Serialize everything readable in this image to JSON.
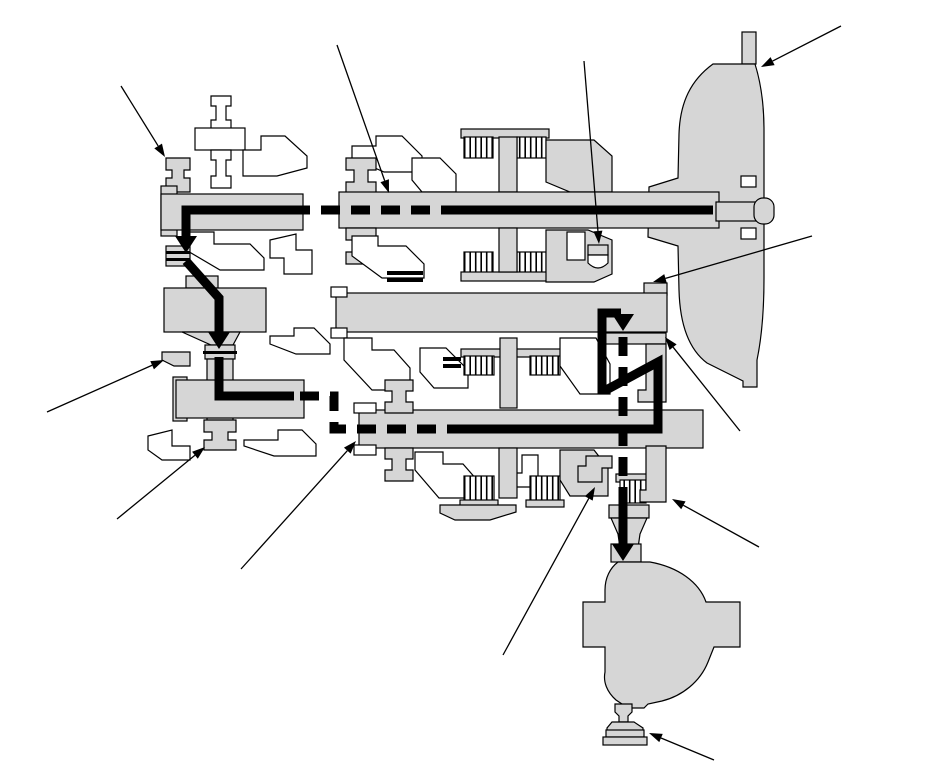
{
  "diagram": {
    "kind": "technical-cross-section",
    "subject": "automatic-transaxle-power-flow",
    "canvas": {
      "width": 950,
      "height": 783
    },
    "colors": {
      "background": "#ffffff",
      "part_fill": "#d6d6d6",
      "outline": "#000000",
      "flow": "#000000",
      "callout": "#000000"
    },
    "power_flow": {
      "stroke_width": 9,
      "dash_pattern": [
        19,
        11
      ],
      "arrow": {
        "length": 17,
        "half_width": 11
      },
      "segments": [
        {
          "style": "solid",
          "points": [
            [
              713,
              210
            ],
            [
              460,
              210
            ]
          ]
        },
        {
          "style": "dashed",
          "points": [
            [
              460,
              210
            ],
            [
              306,
              210
            ]
          ]
        },
        {
          "style": "solid",
          "points": [
            [
              306,
              210
            ],
            [
              186,
              210
            ],
            [
              186,
              237
            ]
          ]
        },
        {
          "style": "arrow-down",
          "tip": [
            186,
            253
          ]
        },
        {
          "style": "solid",
          "points": [
            [
              186,
              261
            ],
            [
              219,
              298
            ],
            [
              219,
              333
            ]
          ]
        },
        {
          "style": "arrow-down",
          "tip": [
            219,
            349
          ]
        },
        {
          "style": "solid",
          "points": [
            [
              219,
              357
            ],
            [
              219,
              396
            ],
            [
              294,
              396
            ]
          ]
        },
        {
          "style": "dashed",
          "points": [
            [
              300,
              396
            ],
            [
              334,
              396
            ],
            [
              334,
              429
            ],
            [
              460,
              429
            ]
          ]
        },
        {
          "style": "solid",
          "points": [
            [
              460,
              429
            ],
            [
              658,
              429
            ],
            [
              658,
              362
            ],
            [
              608,
              389
            ],
            [
              602,
              389
            ],
            [
              602,
              313
            ],
            [
              621,
              313
            ]
          ]
        },
        {
          "style": "arrow-down",
          "tip": [
            623,
            331
          ]
        },
        {
          "style": "dashed",
          "points": [
            [
              623,
              337
            ],
            [
              623,
              503
            ]
          ]
        },
        {
          "style": "solid",
          "points": [
            [
              623,
              503
            ],
            [
              623,
              544
            ]
          ]
        },
        {
          "style": "arrow-down",
          "tip": [
            623,
            561
          ]
        }
      ]
    },
    "callouts": {
      "stroke_width": 1.3,
      "arrow": {
        "length": 13,
        "half_width": 4.5
      },
      "items": [
        {
          "name": "torque-converter",
          "from": [
            841,
            26
          ],
          "to": [
            761,
            67
          ]
        },
        {
          "name": "front-end-cover",
          "from": [
            121,
            86
          ],
          "to": [
            165,
            157
          ]
        },
        {
          "name": "input-shaft",
          "from": [
            337,
            45
          ],
          "to": [
            389,
            193
          ]
        },
        {
          "name": "thrust-bearing",
          "from": [
            584,
            61
          ],
          "to": [
            599,
            244
          ]
        },
        {
          "name": "intermediate-shaft-end",
          "from": [
            812,
            236
          ],
          "to": [
            653,
            282
          ]
        },
        {
          "name": "drive-gear",
          "from": [
            740,
            431
          ],
          "to": [
            665,
            337
          ]
        },
        {
          "name": "idler-bracket",
          "from": [
            47,
            412
          ],
          "to": [
            164,
            360
          ]
        },
        {
          "name": "transfer-hub",
          "from": [
            117,
            519
          ],
          "to": [
            205,
            447
          ]
        },
        {
          "name": "counter-shaft",
          "from": [
            241,
            569
          ],
          "to": [
            356,
            441
          ]
        },
        {
          "name": "clutch-hub",
          "from": [
            503,
            655
          ],
          "to": [
            595,
            487
          ]
        },
        {
          "name": "final-drive-pinion",
          "from": [
            759,
            547
          ],
          "to": [
            672,
            499
          ]
        },
        {
          "name": "output-flange",
          "from": [
            714,
            760
          ],
          "to": [
            649,
            733
          ]
        }
      ]
    }
  }
}
